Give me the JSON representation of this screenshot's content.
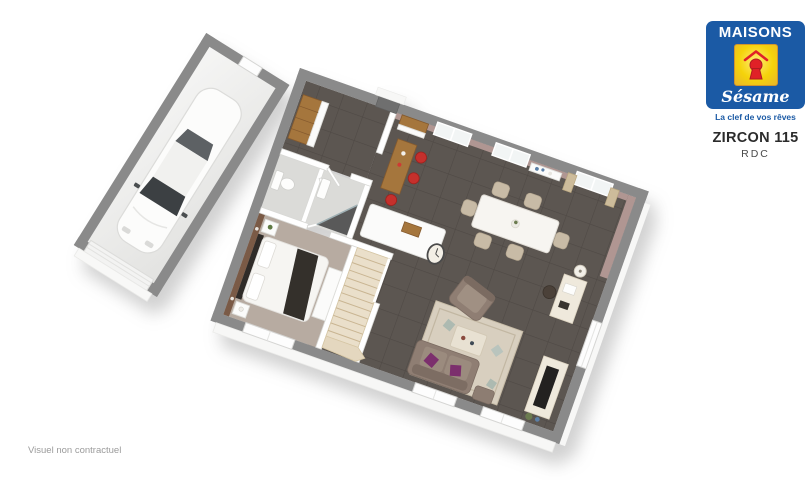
{
  "theme": {
    "page_bg": "#ffffff",
    "brand_blue": "#1b5aa5",
    "brand_yellow": "#f5d30a",
    "brand_red": "#e02127",
    "logo_text": "#ffffff",
    "title_text": "#2b2b2b",
    "subtitle_text": "#4a4a4a",
    "disclaimer_text": "#9b9b9b",
    "wall_gray": "#8a8a8a",
    "interior_wall": "#ffffff",
    "tile_floor": "#5c5651",
    "tile_grout": "#4f4945",
    "wall_mauve": "#b09692",
    "accent_brown": "#7a5a46",
    "carpet_taupe": "#b7aba1",
    "wood": "#a5763d",
    "stool_red": "#c5302c",
    "sofa_taupe": "#8f7e73",
    "cushion_purple": "#7c2f6d",
    "rug_beige": "#d8cfbf",
    "stairs_wood": "#eadfca",
    "curtain_beige": "#cdbc9b"
  },
  "logo": {
    "brand_top": "MAISONS",
    "brand_script": "Sésame",
    "tagline": "La clef de vos rêves"
  },
  "plan_header": {
    "model": "ZIRCON 115",
    "level": "RDC"
  },
  "footer": {
    "disclaimer": "Visuel non contractuel"
  }
}
